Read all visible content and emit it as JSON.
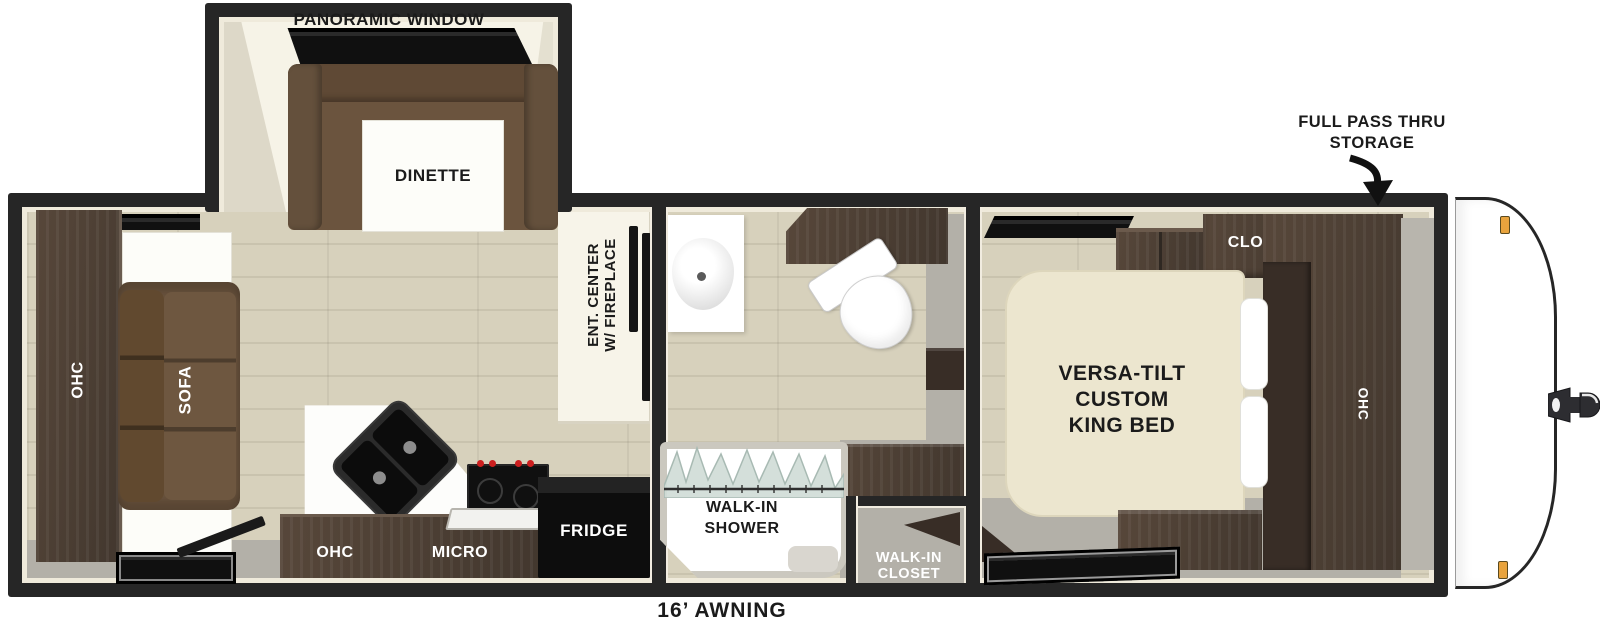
{
  "title": "Travel trailer floor plan",
  "colors": {
    "wall": "#262626",
    "wall_liner": "#efeadb",
    "floor_wood": "#d7d1bc",
    "floor_gray": "#b3b0a8",
    "cabinet_walnut": "#4e4036",
    "cabinet_dark": "#382d26",
    "sofa_brown": "#6b543e",
    "slideout_cream": "#f6f3e7",
    "bed_cream": "#ece6cf",
    "appliance_black": "#121212",
    "fixture_white": "#ffffff",
    "marker_amber": "#e8a33d",
    "shower_glass": "#cfdbd6"
  },
  "slideout": {
    "window_label": "PANORAMIC WINDOW",
    "dinette_label": "DINETTE"
  },
  "living_area": {
    "ohc_label": "OHC",
    "sofa_label": "SOFA",
    "ent_center_line1": "ENT. CENTER",
    "ent_center_line2": "W/ FIREPLACE"
  },
  "kitchen": {
    "ohc_label": "OHC",
    "micro_label": "MICRO",
    "fridge_label": "FRIDGE"
  },
  "bathroom": {
    "shower_line1": "WALK-IN",
    "shower_line2": "SHOWER",
    "closet_line1": "WALK-IN",
    "closet_line2": "CLOSET"
  },
  "bedroom": {
    "closet_label": "CLOSET",
    "bed_line1": "VERSA-TILT",
    "bed_line2": "CUSTOM",
    "bed_line3": "KING BED",
    "ohc_label": "OHC"
  },
  "annotations": {
    "storage_line1": "FULL PASS THRU",
    "storage_line2": "STORAGE",
    "awning_label": "16’ AWNING"
  }
}
